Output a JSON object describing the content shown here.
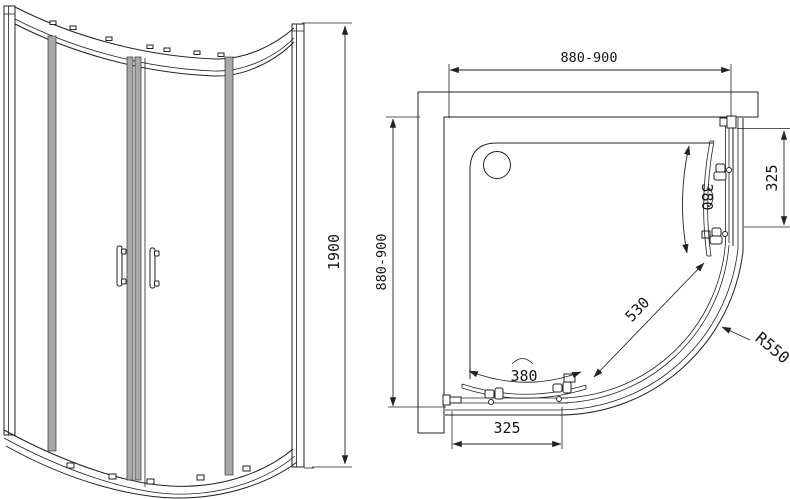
{
  "front_view": {
    "height_dim": "1900"
  },
  "plan_view": {
    "width_dim": "880-900",
    "depth_dim": "880-900",
    "side_panel_dim": "325",
    "front_panel_dim": "325",
    "side_door_dim": "380",
    "front_door_dim": "380",
    "opening_dim": "530",
    "radius_dim": "R550"
  },
  "colors": {
    "line": "#222222",
    "background": "#ffffff",
    "profile_fill": "#a8a8a8"
  }
}
